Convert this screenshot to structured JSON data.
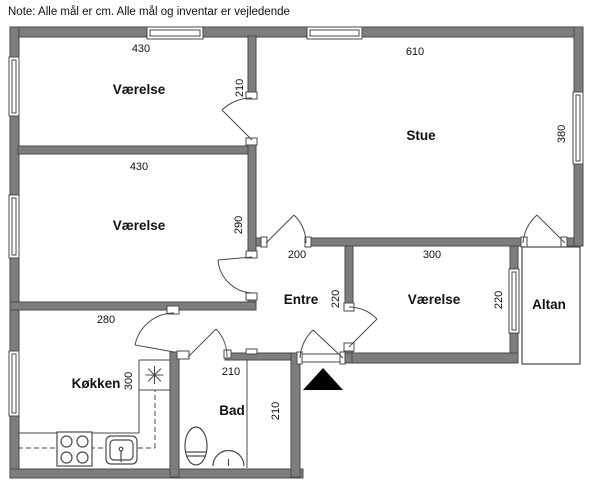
{
  "note": "Note: Alle mål er cm. Alle mål og inventar er vejledende",
  "rooms": {
    "vaerelse_top": {
      "name": "Værelse",
      "width": "430",
      "height": "210"
    },
    "vaerelse_mid": {
      "name": "Værelse",
      "width": "430",
      "height": "290"
    },
    "stue": {
      "name": "Stue",
      "width": "610",
      "height": "380"
    },
    "entre": {
      "name": "Entre",
      "width": "200",
      "height": "220"
    },
    "vaerelse_right": {
      "name": "Værelse",
      "width": "300",
      "height": "220"
    },
    "altan": {
      "name": "Altan"
    },
    "koekken": {
      "name": "Køkken",
      "width": "280",
      "height": "300"
    },
    "bad": {
      "name": "Bad",
      "width": "210",
      "height": "210"
    }
  },
  "colors": {
    "wall": "#7d7d7d",
    "outline": "#4a4a4a",
    "background": "#ffffff",
    "entrance_marker": "#000000"
  }
}
